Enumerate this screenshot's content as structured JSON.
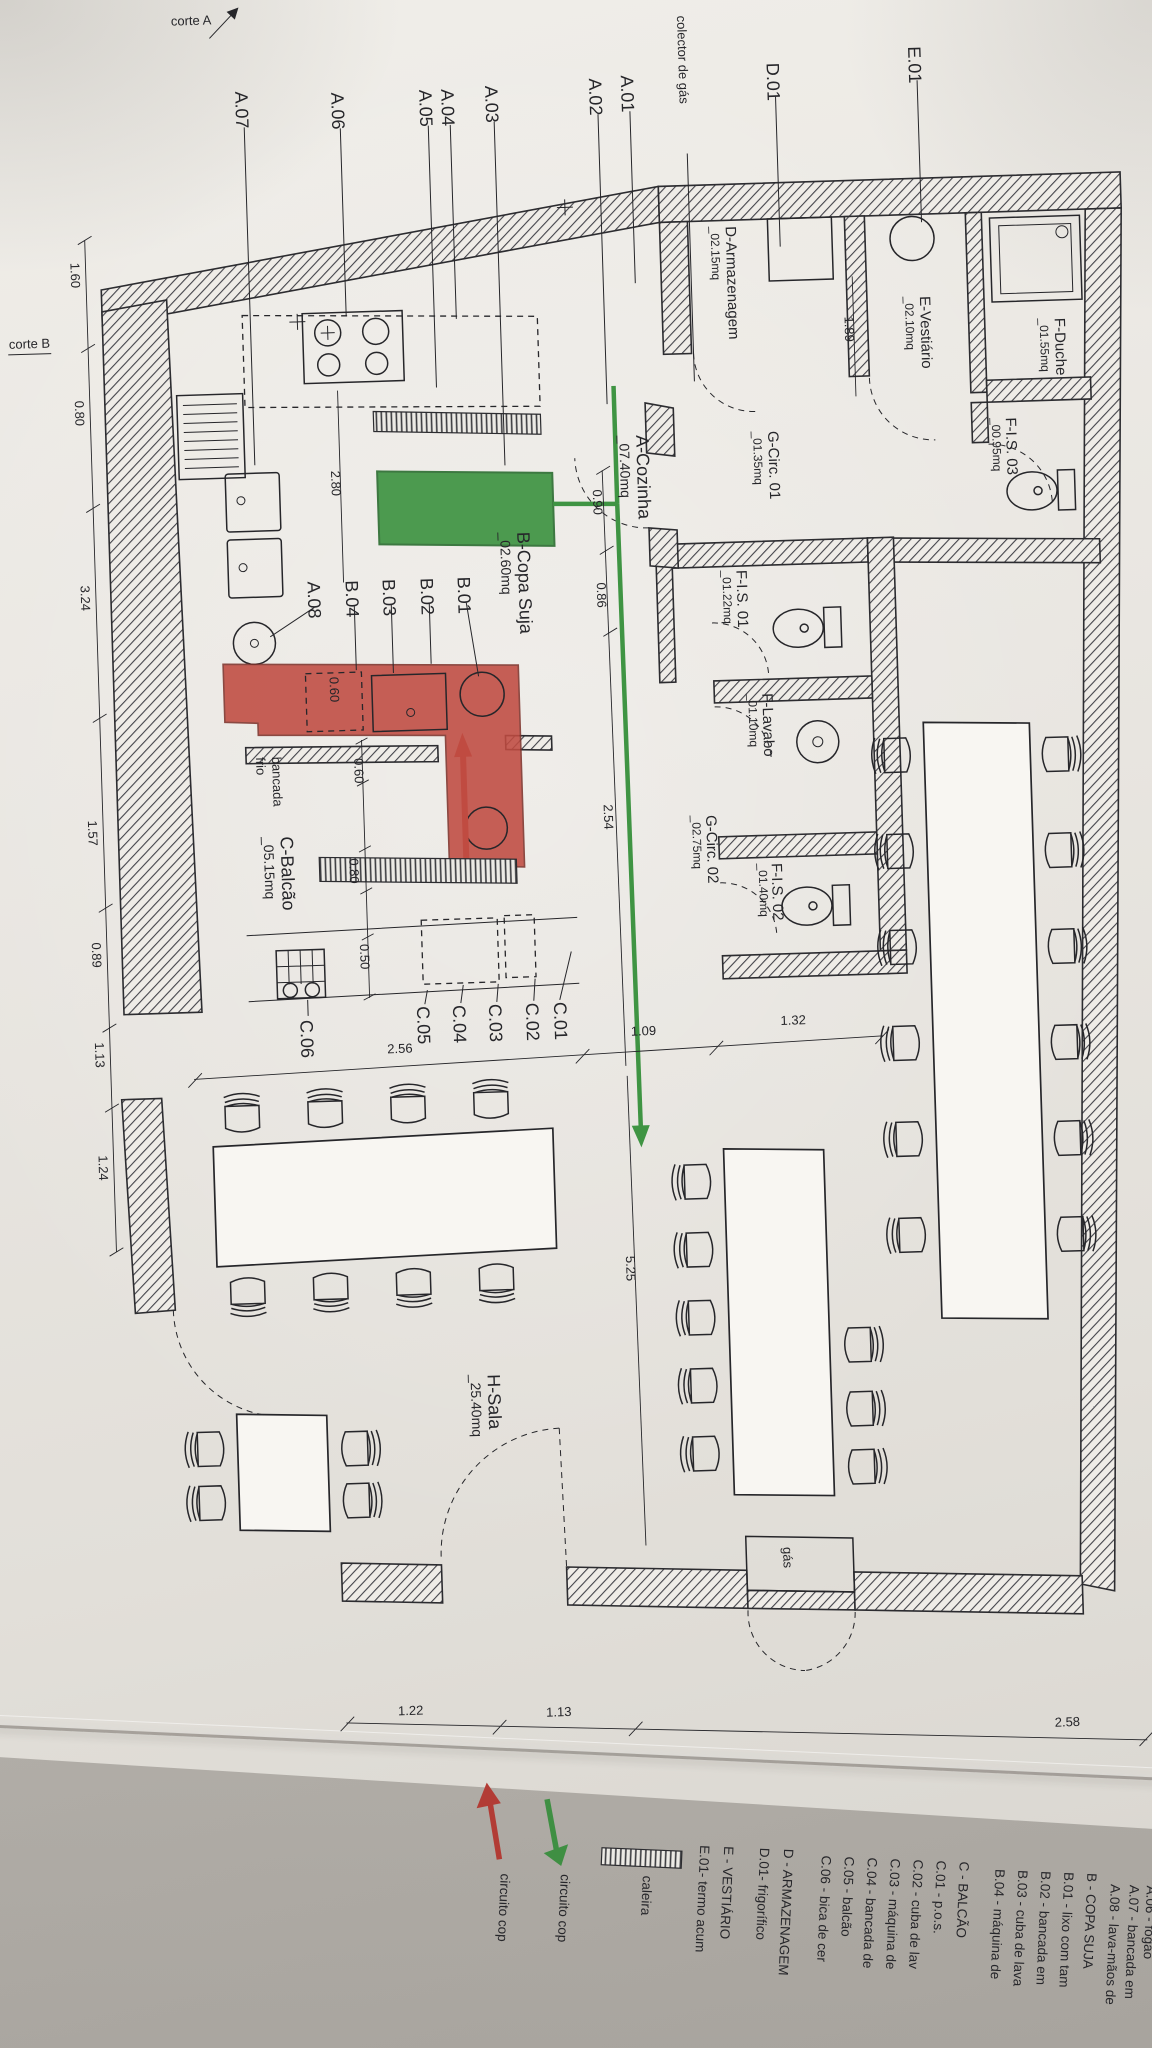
{
  "rooms": {
    "cozinha": {
      "name": "A-Cozinha",
      "area": "_07.40mq"
    },
    "copa_suja": {
      "name": "B-Copa Suja",
      "area": "_02.60mq"
    },
    "balcao": {
      "name": "C-Balcão",
      "area": "_05.15mq"
    },
    "armazenagem": {
      "name": "D-Armazenagem",
      "area": "_02.15mq"
    },
    "vestiario": {
      "name": "E-Vestiário",
      "area": "_02.10mq"
    },
    "duche": {
      "name": "F-Duche",
      "area": "_01.55mq"
    },
    "is01": {
      "name": "F-I.S. 01",
      "area": "_01.22mq"
    },
    "is02": {
      "name": "F-I.S. 02",
      "area": "_01.40mq"
    },
    "is03": {
      "name": "F-I.S. 03",
      "area": "_00.95mq"
    },
    "lavabo": {
      "name": "F-Lavabo",
      "area": "_01.10mq"
    },
    "circ01": {
      "name": "G-Circ. 01",
      "area": "_01.35mq"
    },
    "circ02": {
      "name": "G-Circ. 02",
      "area": "_02.75mq"
    },
    "sala": {
      "name": "H-Sala",
      "area": "_25.40mq"
    }
  },
  "callouts": {
    "e01": "E.01",
    "d01": "D.01",
    "a01": "A.01",
    "a02": "A.02",
    "a03": "A.03",
    "a04": "A.04",
    "a05": "A.05",
    "a06": "A.06",
    "a07": "A.07",
    "a08": "A.08",
    "b01": "B.01",
    "b02": "B.02",
    "b03": "B.03",
    "b04": "B.04",
    "c01": "C.01",
    "c02": "C.02",
    "c03": "C.03",
    "c04": "C.04",
    "c05": "C.05",
    "c06": "C.06",
    "colector_gas": "colector de gás"
  },
  "annotations": {
    "corte_a": "corte A",
    "corte_b": "corte B",
    "gas": "gás",
    "bancada": "bancada",
    "frio": "frio"
  },
  "dims": {
    "left": [
      "1.60",
      "0.80",
      "3.24",
      "1.57",
      "0.89",
      "1.13",
      "1.24"
    ],
    "bottom": [
      "1.22",
      "1.13",
      "2.58"
    ],
    "mid": [
      "2.56",
      "1.09",
      "1.32"
    ],
    "v090": "0.90",
    "v086": "0.86",
    "v254": "2.54",
    "v280": "2.80",
    "v189": "1.89",
    "v060_copa": "0.60",
    "v060_balcao": "0.60",
    "v080": "0.80",
    "v050": "0.50",
    "v525": "5.25"
  },
  "legend": {
    "caleira": "caleira",
    "circuito_red": "circuito cop",
    "circuito_verde": "circuito cop",
    "entries": [
      "E.01- termo acum",
      "E - VESTIÁRIO",
      "D.01- frigorífico",
      "D - ARMAZENAGEM",
      "C.06 - bica de cer",
      "C.05 - balcão",
      "C.04 - bancada de",
      "C.03 - máquina de",
      "C.02 - cuba de lav",
      "C.01 - p.o.s.",
      "C - BALCÃO",
      "B.04 - máquina de",
      "B.03 - cuba de lava",
      "B.02 - bancada em",
      "B.01 - lixo com tam",
      "B - COPA SUJA",
      "A.08 - lava-mãos de",
      "A.07 - bancada em",
      "A.06 - fogão"
    ]
  },
  "colors": {
    "paper": "#e8e5e0",
    "ink": "#26262a",
    "wall": "#3a3a3e",
    "green": "#3f9443",
    "red": "#c04b41"
  }
}
